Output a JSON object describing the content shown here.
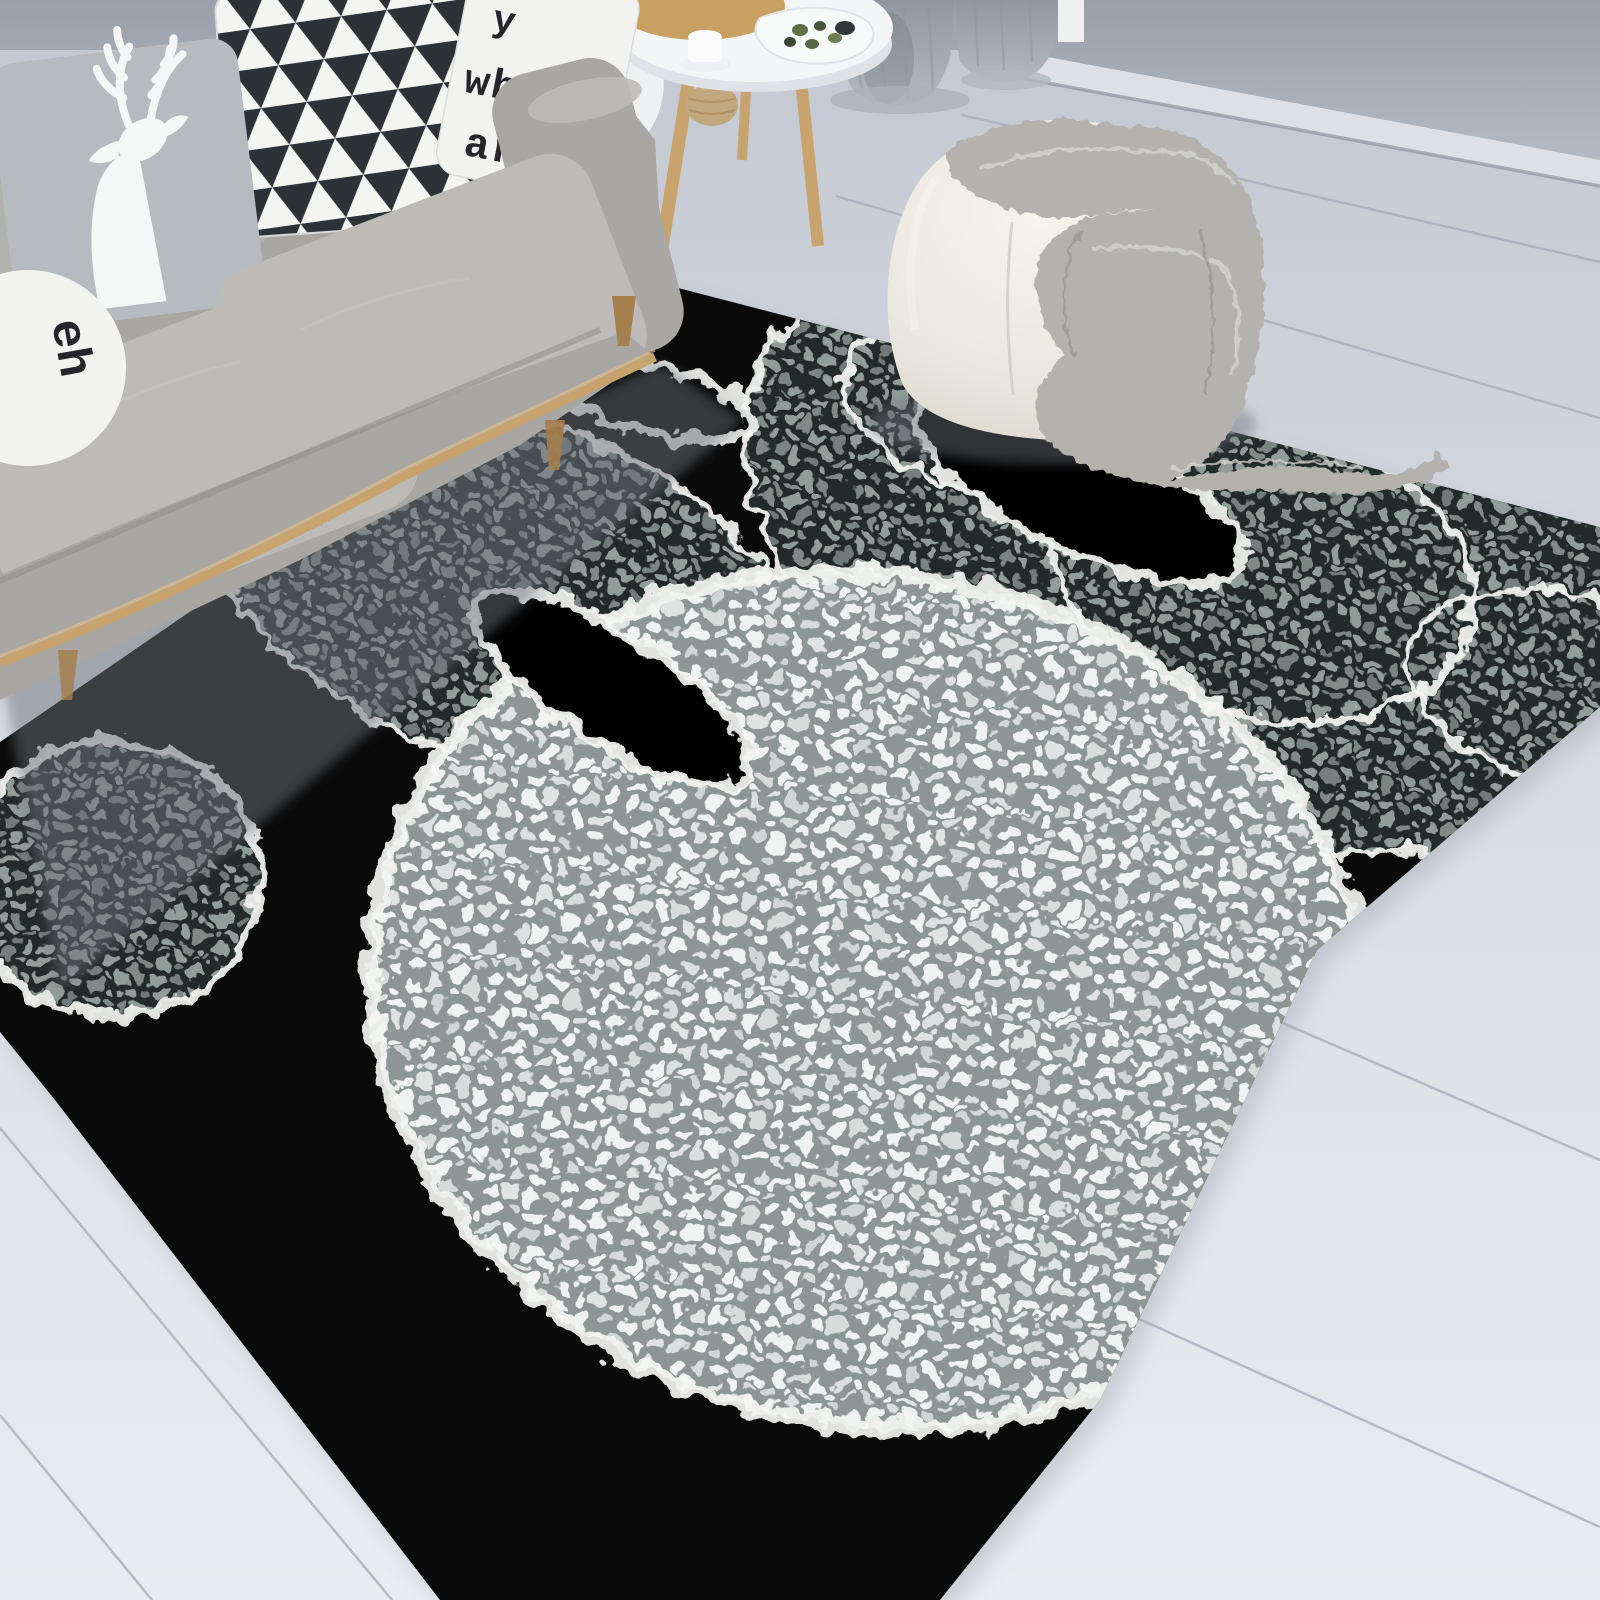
{
  "image_type": "product-lifestyle-photo",
  "texts": {
    "pillow_line1": "y",
    "pillow_line2": "when",
    "pillow_line3": "are",
    "round_pillow_text": "eh"
  },
  "colors": {
    "floor-top": "#c2c7d1",
    "floor-mid": "#d8dbe2",
    "floor-bottom": "#eaecf1",
    "floor-seam": "#a9aeba",
    "wall-top": "#99a0aa",
    "wall-bottom": "#b4bac4",
    "baseboard": "#dde1e7",
    "baseboard-shadow": "#7d828c",
    "curtain-light": "#b3bac3",
    "curtain-dark": "#8f97a1",
    "table-top": "#f4f5f6",
    "wood": "#c9a36e",
    "wood-board": "#c8a061",
    "basket": "#c2a87e",
    "sofa": "#a9a7a4",
    "sofa-light": "#bdbbb8",
    "sofa-dark": "#8e8c89",
    "sofa-shadow": "#6e727a",
    "pillow-gray": "#b7babe",
    "pillow-white": "#f2f2f1",
    "triangle-dark": "#2e3237",
    "text-ink": "#26262a",
    "deer": "#f5f6f6",
    "pouf": "#eae7de",
    "blanket": "#b3b2ae",
    "blanket-light": "#d6d5d1",
    "blanket-dark": "#8d8c88",
    "rug-black": "#0a0a0a",
    "pebble-dark-bg": "#20292a",
    "pebble-dark-dot": "#919d99",
    "pebble-light-bg": "#8b9695",
    "pebble-light-dot": "#eef2f1",
    "fringe": "#f4f5f3"
  }
}
